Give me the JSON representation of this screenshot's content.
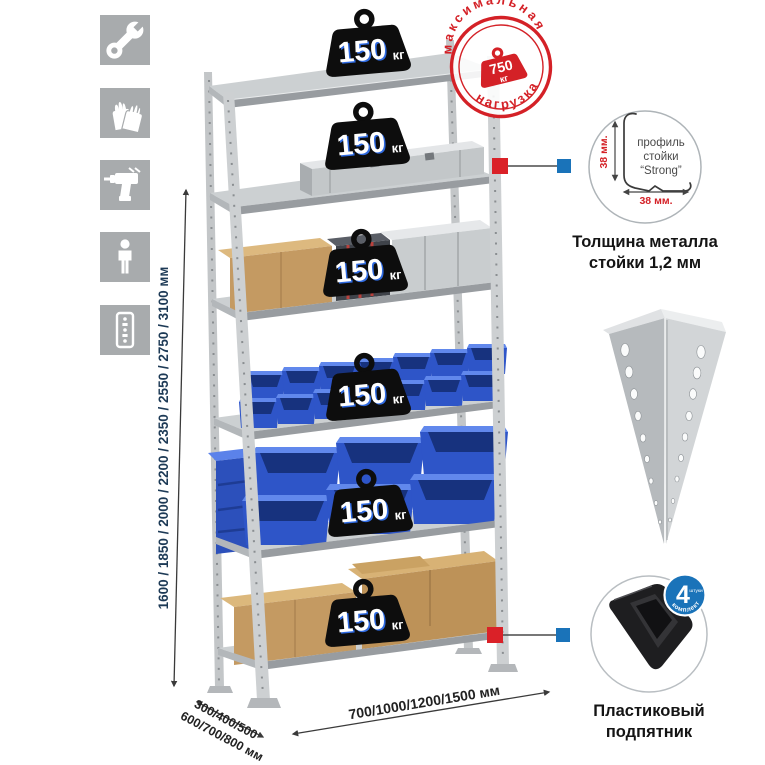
{
  "sidebar": {
    "icons": [
      {
        "name": "wrench"
      },
      {
        "name": "gloves"
      },
      {
        "name": "drill"
      },
      {
        "name": "person"
      },
      {
        "name": "rack-post"
      }
    ]
  },
  "dimensions": {
    "height": "1600 / 1850 / 2000 / 2200 / 2350 / 2550 / 2750 / 3100 мм",
    "depth_line1": "300/400/500",
    "depth_line2": "600/700/800 мм",
    "width": "700/1000/1200/1500 мм"
  },
  "rack": {
    "shelves": [
      {
        "capacity": "150",
        "unit": "кг"
      },
      {
        "capacity": "150",
        "unit": "кг"
      },
      {
        "capacity": "150",
        "unit": "кг"
      },
      {
        "capacity": "150",
        "unit": "кг"
      },
      {
        "capacity": "150",
        "unit": "кг"
      },
      {
        "capacity": "150",
        "unit": "кг"
      }
    ]
  },
  "stamp": {
    "top": "максимальная",
    "bottom": "нагрузка",
    "value": "750",
    "unit": "кг"
  },
  "details": {
    "profile": {
      "line1": "профиль",
      "line2": "стойки",
      "line3": "“Strong”",
      "dim_vertical": "38 мм.",
      "dim_horizontal": "38 мм.",
      "caption_line1": "Толщина металла",
      "caption_line2": "стойки 1,2 мм"
    },
    "foot": {
      "badge_value": "4",
      "badge_small": "штуки",
      "badge_arc": "в комплекте",
      "caption_line1": "Пластиковый",
      "caption_line2": "подпятник"
    }
  },
  "colors": {
    "accent_red": "#d42127",
    "accent_blue": "#1a73b9",
    "dim_text_navy": "#1d3a56",
    "icon_gray": "#a8abad",
    "bin_blue": "#2e55c8"
  }
}
